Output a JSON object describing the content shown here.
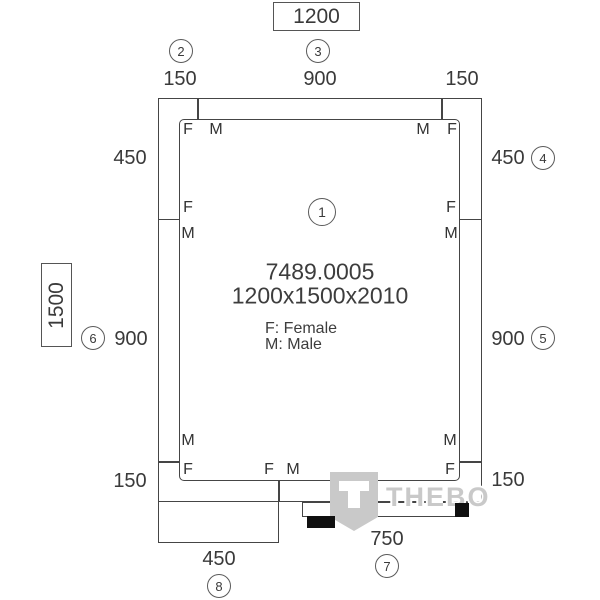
{
  "center": {
    "article": "7489.0005",
    "size": "1200x1500x2010",
    "legend_female": "F: Female",
    "legend_male": "M: Male"
  },
  "dims": {
    "width_total": "1200",
    "height_total": "1500",
    "top": {
      "left": "150",
      "middle": "900",
      "right": "150"
    },
    "side_left": {
      "upper": "450",
      "middle": "900",
      "lower": "150"
    },
    "side_right": {
      "upper": "450",
      "middle": "900",
      "lower": "150"
    },
    "bottom": {
      "panel": "450",
      "door": "750"
    }
  },
  "balloons": {
    "b1": "1",
    "b2": "2",
    "b3": "3",
    "b4": "4",
    "b5": "5",
    "b6": "6",
    "b7": "7",
    "b8": "8"
  },
  "connectors": {
    "female": "F",
    "male": "M"
  },
  "watermark": {
    "brand": "THEBO"
  },
  "colors": {
    "line": "#454545",
    "text": "#3a3a3a",
    "watermark_gray": "#c9c9c9",
    "accent_black": "#101010",
    "background": "#ffffff"
  }
}
